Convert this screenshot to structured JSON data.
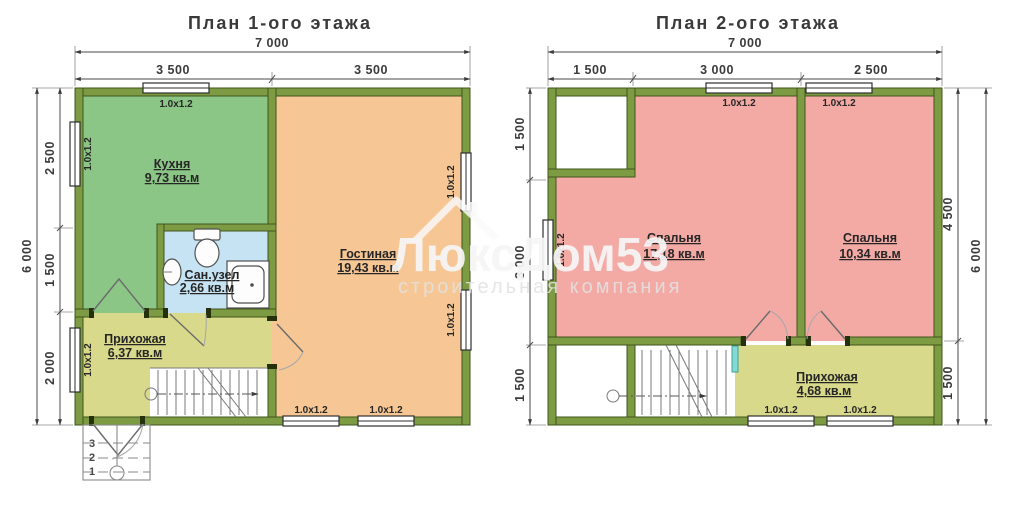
{
  "watermark": {
    "brand": "ЛюксДом53",
    "subtitle": "строительная компания"
  },
  "window_label": "1.0x1.2",
  "colors": {
    "wall": "#7c9b43",
    "kitchen": "#8cc687",
    "living": "#f6c795",
    "bathroom": "#c5e3f3",
    "hallway": "#d8d98a",
    "bedroom": "#f3a9a4",
    "railing": "#86d8d2"
  },
  "plan1": {
    "title": "План 1-ого этажа",
    "dims": {
      "total_w": "7 000",
      "w1": "3 500",
      "w2": "3 500",
      "total_h": "6 000",
      "h1": "2 500",
      "h2": "1 500",
      "h3": "2 000"
    },
    "rooms": {
      "kitchen": {
        "name": "Кухня",
        "area": "9,73 кв.м"
      },
      "living": {
        "name": "Гостиная",
        "area": "19,43 кв.м"
      },
      "bathroom": {
        "name": "Сан.узел",
        "area": "2,66 кв.м"
      },
      "hallway": {
        "name": "Прихожая",
        "area": "6,37 кв.м"
      }
    },
    "porch": {
      "s3": "3",
      "s2": "2",
      "s1": "1"
    }
  },
  "plan2": {
    "title": "План 2-ого этажа",
    "dims": {
      "total_w": "7 000",
      "w1": "1 500",
      "w2": "3 000",
      "w3": "2 500",
      "left_top": "1 500",
      "left_mid": "3 000",
      "left_bottom": "1 500",
      "right_top": "4 500",
      "right_bottom": "1 500",
      "total_h": "6 000"
    },
    "rooms": {
      "bedroom1": {
        "name": "Спальня",
        "area": "17,18 кв.м"
      },
      "bedroom2": {
        "name": "Спальня",
        "area": "10,34 кв.м"
      },
      "hallway": {
        "name": "Прихожая",
        "area": "4,68 кв.м"
      }
    }
  }
}
